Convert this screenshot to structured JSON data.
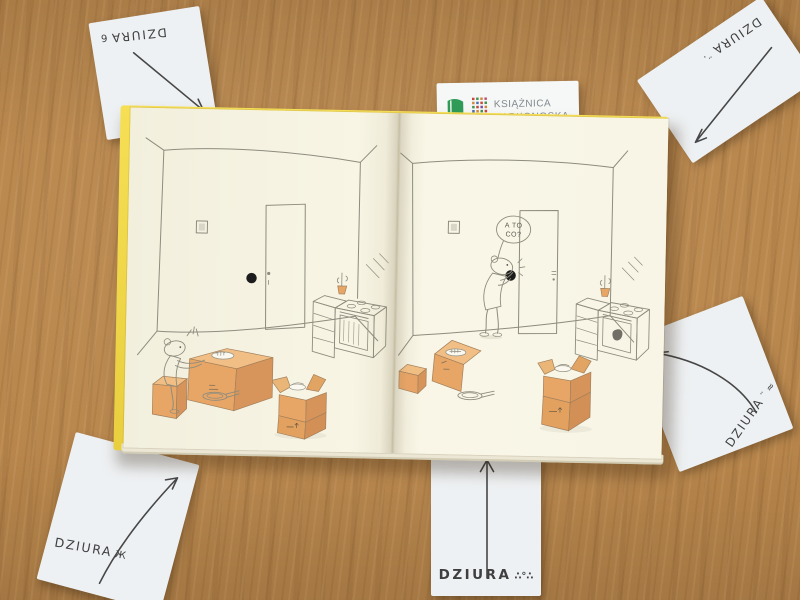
{
  "scene": {
    "description": "Open children's picture book lying flat on a wooden table; five white cards with handwritten arrows point at details of the illustrations; a library logo card sticks out from under the top edge of the book",
    "word_on_cards": "DZIURA"
  },
  "logo_card": {
    "line1": "KSIĄŻNICA",
    "line2": "KARKONOSKA"
  },
  "cards": {
    "top_left": {
      "label": "DZIURA",
      "doodle": "6",
      "arrow_direction": "down-right",
      "text_orientation": "upside-down"
    },
    "top_right": {
      "label": "DZIURA",
      "doodle": "¨·",
      "arrow_direction": "down-left",
      "text_orientation": "upside-down"
    },
    "right_middle": {
      "label": "DZIURA",
      "doodle": "¨ ≈",
      "arrow_direction": "up-left",
      "text_orientation": "diagonal"
    },
    "bottom_left": {
      "label": "DZIURA",
      "doodle": "Ж",
      "arrow_direction": "up-right",
      "text_orientation": "horizontal"
    },
    "bottom_center": {
      "label": "DZIURA",
      "doodle": "∴°∴",
      "arrow_direction": "up",
      "text_orientation": "horizontal"
    }
  },
  "book": {
    "left_page": {
      "scene": "mouse sitting on a small box eating at a cardboard-box table beside a black hole in the wall next to the door; kitchen stove in the corner; open moving box and frying pan on the floor"
    },
    "right_page": {
      "speech_bubble_line1": "A TO",
      "speech_bubble_line2": "CO?",
      "scene": "mouse bent over looking at the black hole in the wall beside the door; moving boxes, plate and frying pan on the floor; kitchen stove in the corner"
    }
  },
  "colors": {
    "table_wood": "#b7854b",
    "page_cream": "#f7f4e3",
    "cover_yellow": "#f2d84a",
    "card_white": "#eef1f3",
    "box_orange": "#e7a666",
    "logo_green": "#2f9b57",
    "ink": "#3f3f3f",
    "line_art": "#8e8c7e",
    "hole_black": "#1c1c1c"
  }
}
